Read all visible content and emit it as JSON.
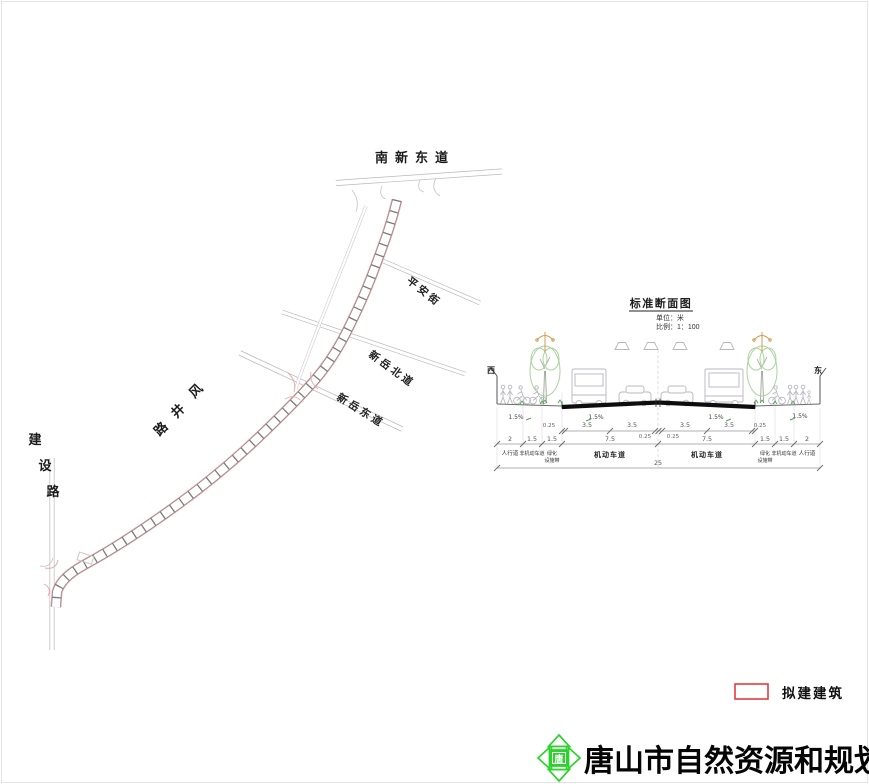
{
  "plan": {
    "streets": {
      "nanxindong": "南新东道",
      "pingan": "平安街",
      "xinyue_north": "新岳北道",
      "xinyue_east": "新岳东道",
      "fengjing": "风井路",
      "jianshe": "建设路"
    }
  },
  "section": {
    "title": "标准断面图",
    "unit_label": "单位：米",
    "scale_label": "比例：1：100",
    "west": "西",
    "east": "东",
    "slope": "1.5%",
    "dim_edge": "0.25",
    "dim_lane": "3.5",
    "dim_walk": "2",
    "dim_bike": "1.5",
    "dim_green": "1.5",
    "dim_carriage": "7.5",
    "dim_total": "25",
    "labels": {
      "walk": "人行道",
      "bike": "非机动车道",
      "green1": "绿化",
      "green2": "设施带",
      "motor": "机动车道"
    }
  },
  "legend": {
    "item": "拟建建筑"
  },
  "footer": {
    "agency": "唐山市自然资源和规划局",
    "logo_char": "唐"
  },
  "colors": {
    "legend_red": "#e23c3c",
    "logo_green": "#2bd32b",
    "road_redline": "#eb9c9c",
    "tree_green": "#a8d49c",
    "lamp_orange": "#cf9b50"
  }
}
